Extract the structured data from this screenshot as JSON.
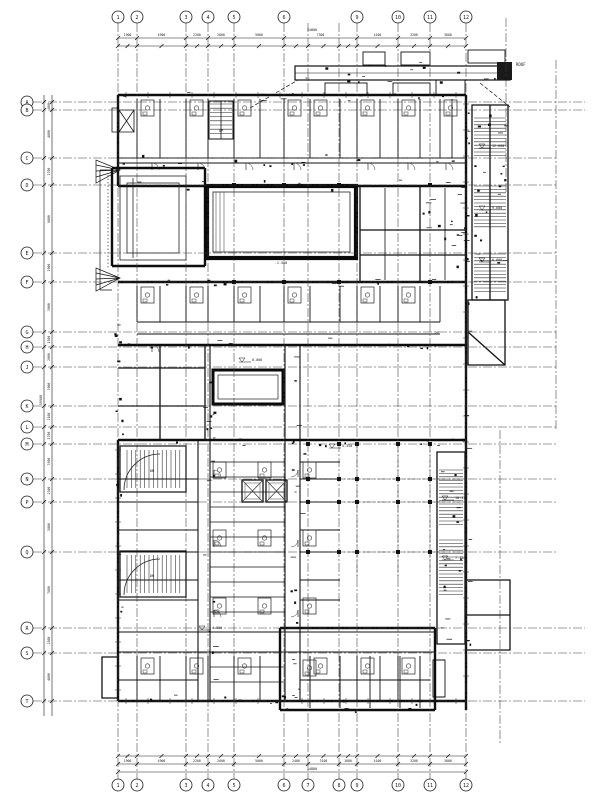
{
  "drawing": {
    "background": "#ffffff",
    "line_color": "#1a1a1a",
    "wall_color": "#0d0d0d",
    "grid_color": "#3a3a3a"
  },
  "grid": {
    "column_labels": [
      "1",
      "2",
      "3",
      "4",
      "5",
      "6",
      "7",
      "8",
      "9",
      "10",
      "11",
      "12"
    ],
    "row_labels": [
      "A",
      "B",
      "C",
      "D",
      "E",
      "F",
      "G",
      "H",
      "J",
      "K",
      "L",
      "M",
      "N",
      "P",
      "Q",
      "R",
      "S",
      "T"
    ]
  },
  "dimensions": {
    "top_segments": [
      "1900",
      "4900",
      "2200",
      "2600",
      "5000",
      "7300",
      "4100",
      "3200",
      "3600"
    ],
    "top_overall": "34800",
    "bottom_segments": [
      "1900",
      "4900",
      "2200",
      "2600",
      "5000",
      "2400",
      "3100",
      "1800",
      "4100",
      "3200",
      "3600"
    ],
    "bottom_overall": "34800",
    "left_segments": [
      "800",
      "4800",
      "2700",
      "6800",
      "2900",
      "5000",
      "1500",
      "2000",
      "3900",
      "2100",
      "1700",
      "3500",
      "2300",
      "5000",
      "7600",
      "2500",
      "4800"
    ],
    "left_overall": "59900"
  },
  "annotations": {
    "elevations": [
      "12.600",
      "9.600",
      "6.600",
      "10.150",
      "7.150",
      "0.000",
      "5.350",
      "4.500"
    ],
    "roof_label": "ROOF",
    "up_label": "UP",
    "down_label": "DN",
    "floor_label": "2F",
    "pool_level": "-1.500"
  }
}
